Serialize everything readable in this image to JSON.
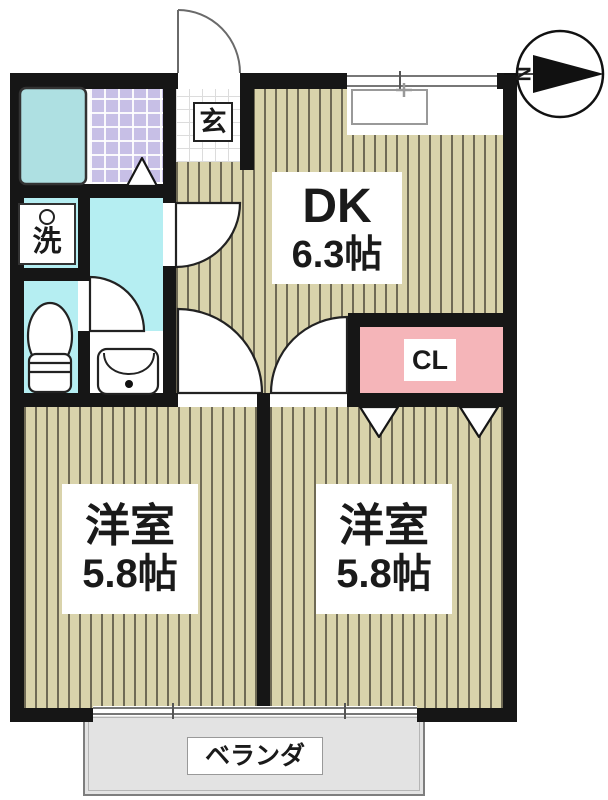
{
  "plan_type": "apartment-floor-plan",
  "compass": {
    "north_label": "N"
  },
  "rooms": {
    "genkan": {
      "label": "玄"
    },
    "laundry": {
      "label": "洗"
    },
    "dk": {
      "name": "DK",
      "size": "6.3帖"
    },
    "closet": {
      "label": "CL"
    },
    "bedroom_left": {
      "name": "洋室",
      "size": "5.8帖"
    },
    "bedroom_right": {
      "name": "洋室",
      "size": "5.8帖"
    },
    "veranda": {
      "label": "ベランダ"
    }
  },
  "fixtures": [
    "bathtub",
    "washing-machine-tap",
    "toilet",
    "washbasin",
    "kitchen-sink"
  ],
  "colors": {
    "wall": "#161616",
    "room_floor": "#d9d3ab",
    "room_stripe": "#6f6a55",
    "hallway_floor": "#b5eef2",
    "bath_tile": "#c7bfe6",
    "bathtub": "#aee0e2",
    "closet": "#f5b5b9",
    "balcony": "#e3e3e3"
  }
}
